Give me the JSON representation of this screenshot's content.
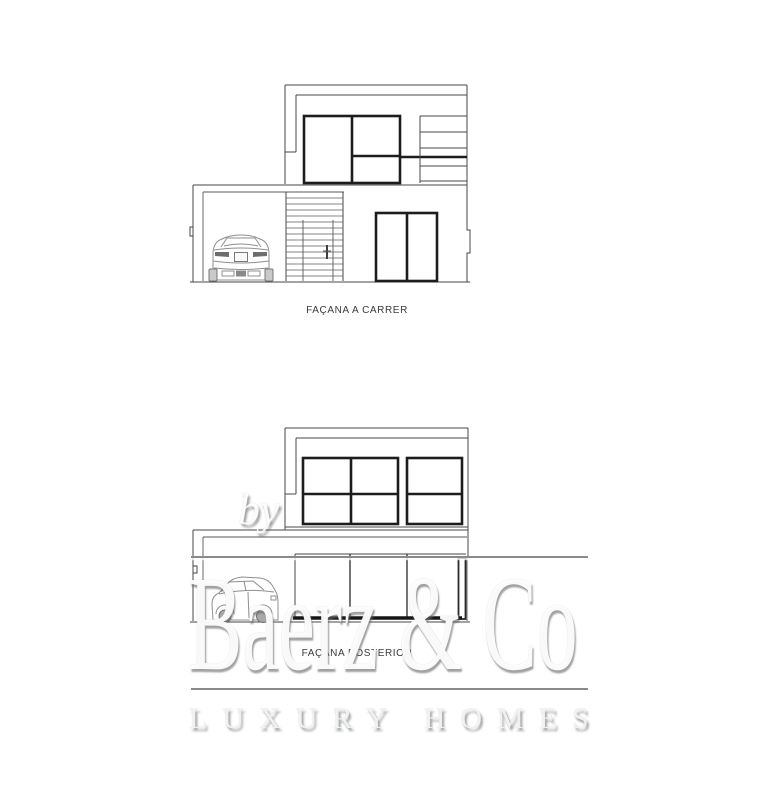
{
  "drawings": {
    "street": {
      "label": "FAÇANA A CARRER"
    },
    "rear": {
      "label": "FAÇANA POSTERIOR"
    }
  },
  "watermark": {
    "prefix": "by",
    "brand": "Baerz & Co",
    "tagline": "LUXURY HOMES",
    "text_color": "#ffffff",
    "shadow_color": "#6a6a6a",
    "rule_color": "#8a8a8a"
  },
  "colors": {
    "background": "#ffffff",
    "thin_line": "#474747",
    "window_frame": "#1d1d1d",
    "label_text": "#3a3a3a",
    "car_line": "#8f8f8f"
  }
}
